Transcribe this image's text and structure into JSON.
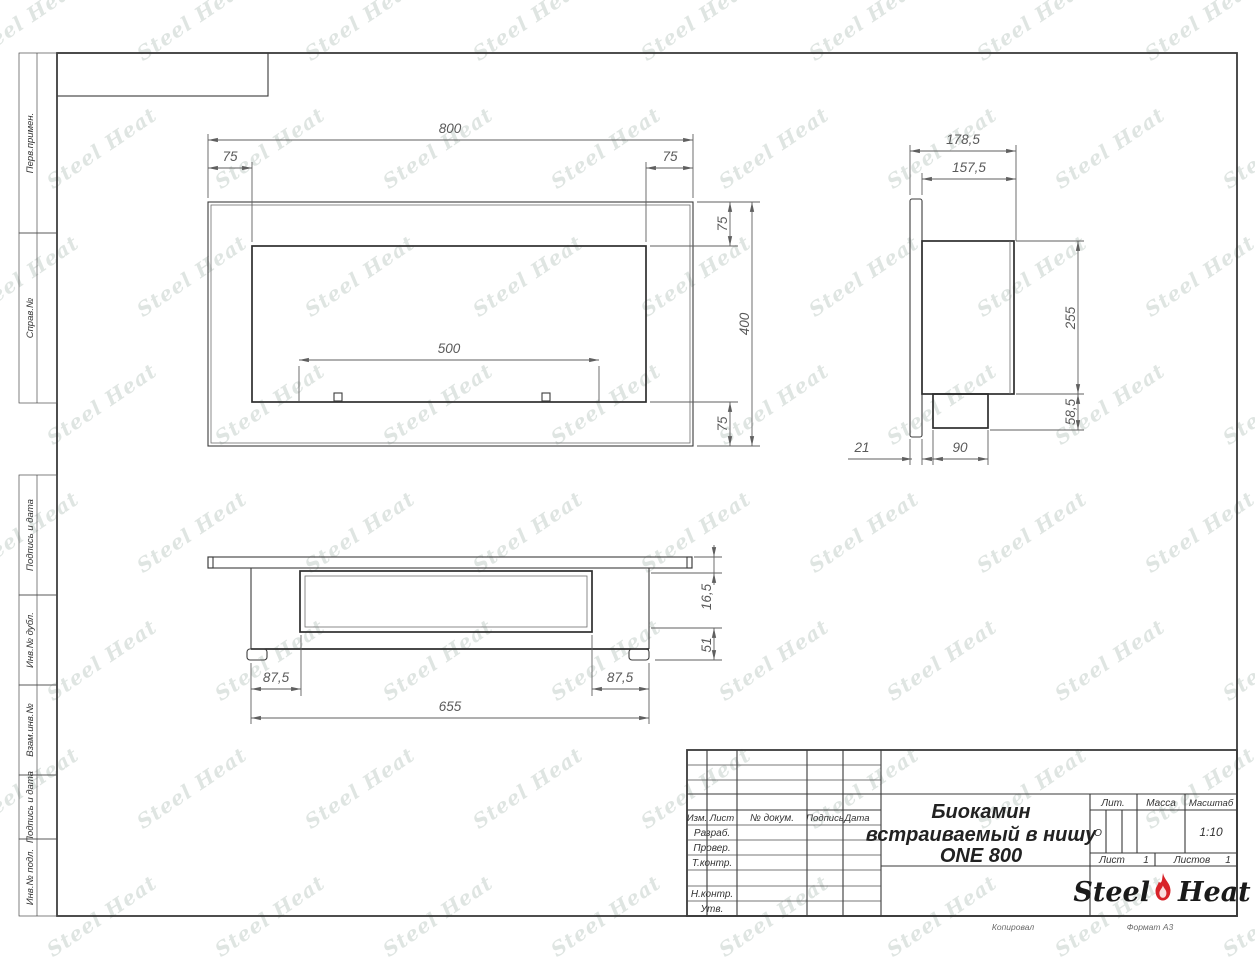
{
  "sheet": {
    "watermark": "Steel Heat",
    "copied_label": "Копировал",
    "format_label": "Формат А3"
  },
  "margin_labels": {
    "perv_primen": "Перв.примен.",
    "sprav_no": "Справ.№",
    "podpis_data_1": "Подпись и дата",
    "inv_dubl": "Инв.№ дубл.",
    "vzam_inv": "Взам.инв.№",
    "podpis_data_2": "Подпись и дата",
    "inv_podl": "Инв.№ подл."
  },
  "title_block": {
    "cols": {
      "izm": "Изм.",
      "list": "Лист",
      "doc": "№ докум.",
      "sign": "Подпись",
      "date": "Дата"
    },
    "rows": {
      "razrab": "Разраб.",
      "prover": "Провер.",
      "tkontr": "Т.контр.",
      "nkontr": "Н.контр.",
      "utv": "Утв."
    },
    "title_line1": "Биокамин",
    "title_line2": "встраиваемый в нишу",
    "title_line3": "ONE 800",
    "lit_label": "Лит.",
    "lit_value": "О",
    "massa_label": "Масса",
    "masshtab_label": "Масштаб",
    "masshtab_value": "1:10",
    "list_label": "Лист",
    "list_value": "1",
    "listov_label": "Листов",
    "listov_value": "1",
    "logo_left": "Steel",
    "logo_right": "Heat",
    "logo_accent_color": "#d8232a"
  },
  "views": {
    "front": {
      "name": "front-view",
      "dims": {
        "width": "800",
        "offset_left": "75",
        "offset_right": "75",
        "offset_top": "75",
        "height": "400",
        "offset_bottom": "75",
        "burner": "500"
      }
    },
    "side": {
      "name": "side-view",
      "dims": {
        "depth_total": "178,5",
        "depth_body": "157,5",
        "body_height": "255",
        "tray_height": "58,5",
        "wall_thickness": "21",
        "tray_width": "90"
      }
    },
    "top": {
      "name": "top-view",
      "dims": {
        "front_gap": "16,5",
        "glass_depth": "51",
        "inset_left": "87,5",
        "inset_right": "87,5",
        "niche_width": "655"
      }
    }
  }
}
